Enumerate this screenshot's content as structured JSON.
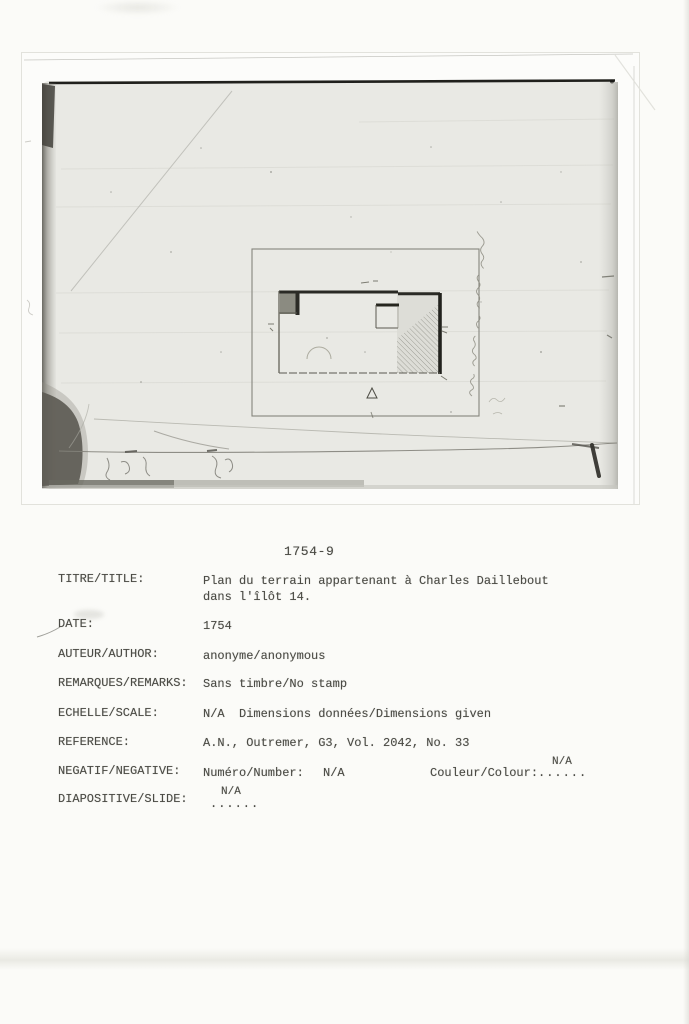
{
  "catalog": {
    "number": "1754-9",
    "title": {
      "label": "TITRE/TITLE:",
      "line1": "Plan du terrain appartenant à Charles Daillebout",
      "line2": "dans l'îlôt 14."
    },
    "date": {
      "label": "DATE:",
      "value": "1754"
    },
    "author": {
      "label": "AUTEUR/AUTHOR:",
      "value": "anonyme/anonymous"
    },
    "remarks": {
      "label": "REMARQUES/REMARKS:",
      "value": "Sans timbre/No stamp"
    },
    "scale": {
      "label": "ECHELLE/SCALE:",
      "value": "N/A  Dimensions données/Dimensions given"
    },
    "reference": {
      "label": "REFERENCE:",
      "value": "A.N., Outremer, G3, Vol. 2042, No. 33"
    },
    "negative": {
      "label": "NEGATIF/NEGATIVE:",
      "number_label": "Numéro/Number:",
      "number_value": "N/A",
      "colour_label": "Couleur/Colour:",
      "colour_dots": "......",
      "colour_value": "N/A"
    },
    "slide": {
      "label": "DIAPOSITIVE/SLIDE:",
      "dots": "......",
      "value": "N/A"
    }
  },
  "colors": {
    "ink": "#4b4b45",
    "page": "#fbfbf8",
    "photo_paper": "#e9e9e4",
    "photo_dark_edge": "#20201c",
    "plan_line": "#2a2a25"
  }
}
